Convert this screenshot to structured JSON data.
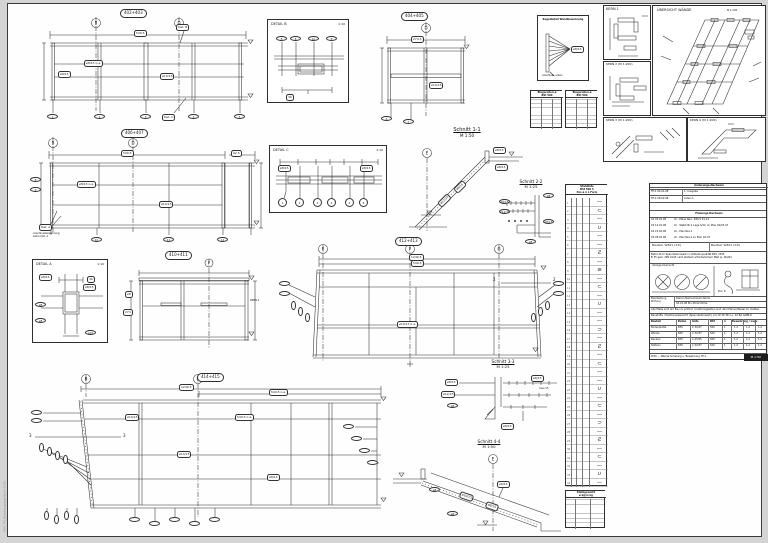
{
  "margin_note": "W30_TP1_Bewehrung.dwg  Plot 04.01.08",
  "drawings": {
    "elev1": {
      "no": "402+403",
      "grid": [
        "B",
        "D"
      ],
      "dim_top": "549.5",
      "ref_b": "Det. B",
      "ref_c": "Det. C",
      "cap1": "ø8/15 ü.a.",
      "cap2": "ø10/15",
      "cap3": "ø8/15",
      "pos": [
        "1",
        "2",
        "3",
        "4",
        "5"
      ]
    },
    "detailB": {
      "title": "DETAIL B",
      "scale": "1:10",
      "pos": [
        "8",
        "8",
        "10",
        "8"
      ],
      "dim": "30"
    },
    "elevTM": {
      "no": "404+405",
      "grid": "D",
      "dim_top": "274.5",
      "cap1": "ø10/15",
      "pos": [
        "6",
        "7"
      ]
    },
    "noteBox": {
      "line1": "Regeldetail",
      "line2": "Wandbewehrung",
      "callout": "ø8/15",
      "foot": "Anschluss unten"
    },
    "miniT1": {
      "h1": "Biegerollen-ø",
      "h2": "BSt 500"
    },
    "miniT2": {
      "h1": "Biegerollen-ø",
      "h2": "BSt 500"
    },
    "kern1": {
      "title": "KERN 1"
    },
    "kern2": {
      "title": "KERN 2 (M 1:200)"
    },
    "kern3": {
      "title": "KERN 3 (M 1:200)"
    },
    "kern4": {
      "title": "KERN 4 (M 1:200)"
    },
    "uebersicht": {
      "title": "ÜBERSICHT WÄNDE",
      "scale": "M 1:200"
    },
    "elev2": {
      "no": "406+407",
      "grid": [
        "B",
        "D"
      ],
      "dim_top": "549.5",
      "dim_right": "92.5",
      "cap1": "ø8/15 ü.a.",
      "cap2": "ø10/15",
      "ref_a": "Det. A",
      "note": "Anschlussbewehrung\nsiehe Det. A",
      "pos": [
        "8",
        "9",
        "10",
        "11",
        "12"
      ]
    },
    "detailC": {
      "title": "DETAIL C",
      "scale": "1:10",
      "cap_l": "ø8/15",
      "cap_r": "ø8/15",
      "pos": [
        "1",
        "2",
        "3",
        "4",
        "5",
        "6"
      ]
    },
    "s11": {
      "title": "Schnitt 1-1",
      "scale": "M 1:50",
      "grid": "E",
      "cap1": "ø12/15",
      "cap2": "ø8/15",
      "cap3": "ø8/15",
      "cap4": "ø8/15"
    },
    "s22": {
      "title": "Schnitt 2-2",
      "scale": "M 1:25",
      "c1": "ø8/15",
      "c2": "ø12/15",
      "c3": "ø8",
      "c4": "ø8/15",
      "c5": "ø8"
    },
    "s33": {
      "title": "Schnitt 3-3",
      "scale": "M 1:25",
      "c1": "ø8/15",
      "c2": "ø12/15",
      "c3": "ø8",
      "c4": "ø8/15",
      "c5": "max.15",
      "c6": "ø8/15"
    },
    "s44": {
      "title": "Schnitt 4-4",
      "scale": "M 1:50",
      "grid": "E",
      "cap1": "ø10/15",
      "cap2": "ø8/15",
      "cap3": "ø8",
      "cap4": "ø8/15",
      "cap5": "ø8"
    },
    "detailA": {
      "title": "DETAIL A",
      "scale": "1:10",
      "c1": "ø8/15",
      "c2": "ø8/15",
      "c3": "30",
      "c4": "ø8",
      "c5": "ø8",
      "c6": "ø10"
    },
    "elevS": {
      "no": "410+411",
      "grid": "F",
      "cap1": "ø8",
      "note": "KERN 4",
      "dim": "274"
    },
    "elevC": {
      "no": "412+413",
      "grid": [
        "E",
        "F",
        "G"
      ],
      "dim1": "1249.5",
      "dim2": "549.5",
      "cap1": "ø10/15 ü.a.",
      "sec": "2"
    },
    "elevBL": {
      "no": "414+415",
      "grid": [
        "B",
        "D"
      ],
      "dim1": "1249.5",
      "dim2": "549.5 ü.a.",
      "sec": "3",
      "cap1": "ø10/15",
      "cap2": "549.5 ü.a.",
      "cap3": "ø10/15",
      "cap4": "ø8/15"
    }
  },
  "stahl": {
    "h1": "Stahlliste",
    "h2": "BSt 500 S",
    "h3": "Pos ø n L Form",
    "rows": "1\n2\n3\n4\n5\n6\n7\n8\n9\n10\n11\n12\n13\n14\n15\n16\n17\n18\n19\n20\n21\n22\n23\n24\n25\n26\n27\n28\n29\n30\n31\n32\n33\n34",
    "shapes": "—\n⊂\n—\n∪\n—\n—\nƧ\n—\n≡\n—\n⊂\n—\n∪\n—\n—\n⊃\n—\nƧ\n—\n⊂\n—\n—\n∪\n—\n⊂\n—\n⊃\n—\nƧ\n—\n⊂\n—\n∪\n—"
  },
  "stahlsum": {
    "h": "Stahlgewicht",
    "cols": "ø   kg/m   kg"
  },
  "titleblock": {
    "t1_header": "Änderungs-Nachweis",
    "t1_rows": [
      [
        "TP-1 04.01.08",
        "1. Ausgabe"
      ],
      [
        "TP-2 28.02.08",
        "Index A"
      ]
    ],
    "t2_header": "Planungs-Nachweis",
    "t2_rows": [
      [
        "02 03.01.08",
        "LV - Pläne Rev.: 834 S 01-12"
      ],
      [
        "03 14.01.08",
        "LV - Statik Nr.1 Lage S/12, zu Plan 02/03-07"
      ],
      [
        "04 21.02.08",
        "LV - Plan Rev.1"
      ],
      [
        "05 28.02.08",
        "LV - Plan Rev.1 zu Plan 02-07"
      ]
    ],
    "bauteil_l": "Bauteil:  W301 (±0)",
    "bauteil_r": "Bauteil:  W301 (±0)",
    "note": "Beton B im Spannbetonwerk in Ortbetonqualität B25 / B35\nB 35 gem. DIN 1045 nach statisch erforderlichem Maß (s. Statik)",
    "stamp_caption": "Verlege-Übersicht",
    "stamp_right_caption": "Pos. 8",
    "appr_label": "Bearbeitung\nPrüfung",
    "appr_cols": "Datum      Name      Datum      Name",
    "appr_row": "04.01.08    Mu      28.02.08    Ke",
    "note2": "Alle Maße sind am Bau zu prüfen! Unstimmigkeiten sind dem Planverfasser zu melden.",
    "main_title": "Baustoffe / Positionsübersicht (Spannbetonwerk) von W 30 TP-1 u. 02 BA GWB-8",
    "main_cols": [
      "Bauteil",
      "Beton",
      "Güte",
      "BSt",
      "n",
      "Bewehrung / Lage"
    ],
    "main_rows": [
      [
        "Bodenplatte",
        "B35",
        "C 30/37",
        "500",
        "1",
        "1.2",
        "1.2",
        "1.2"
      ],
      [
        "Wände",
        "B35",
        "C 30/37",
        "500",
        "1",
        "1.2",
        "1.2",
        "1.2"
      ],
      [
        "Decken",
        "B35",
        "C 45/55",
        "500",
        "1",
        "1.2",
        "1.2",
        "1.2"
      ],
      [
        "Stützen",
        "B35",
        "C 30/37",
        "500",
        "1",
        "1.2",
        "1.2",
        "1.2"
      ],
      [
        "Unterzüge",
        "B35",
        "C 30/37",
        "500",
        "1",
        "1.2",
        "1.2",
        "1.2"
      ]
    ],
    "footer_left": "W30 — Wände  Schalung u. Bewehrung  TP-1",
    "footer_scale": "M 1:50"
  }
}
